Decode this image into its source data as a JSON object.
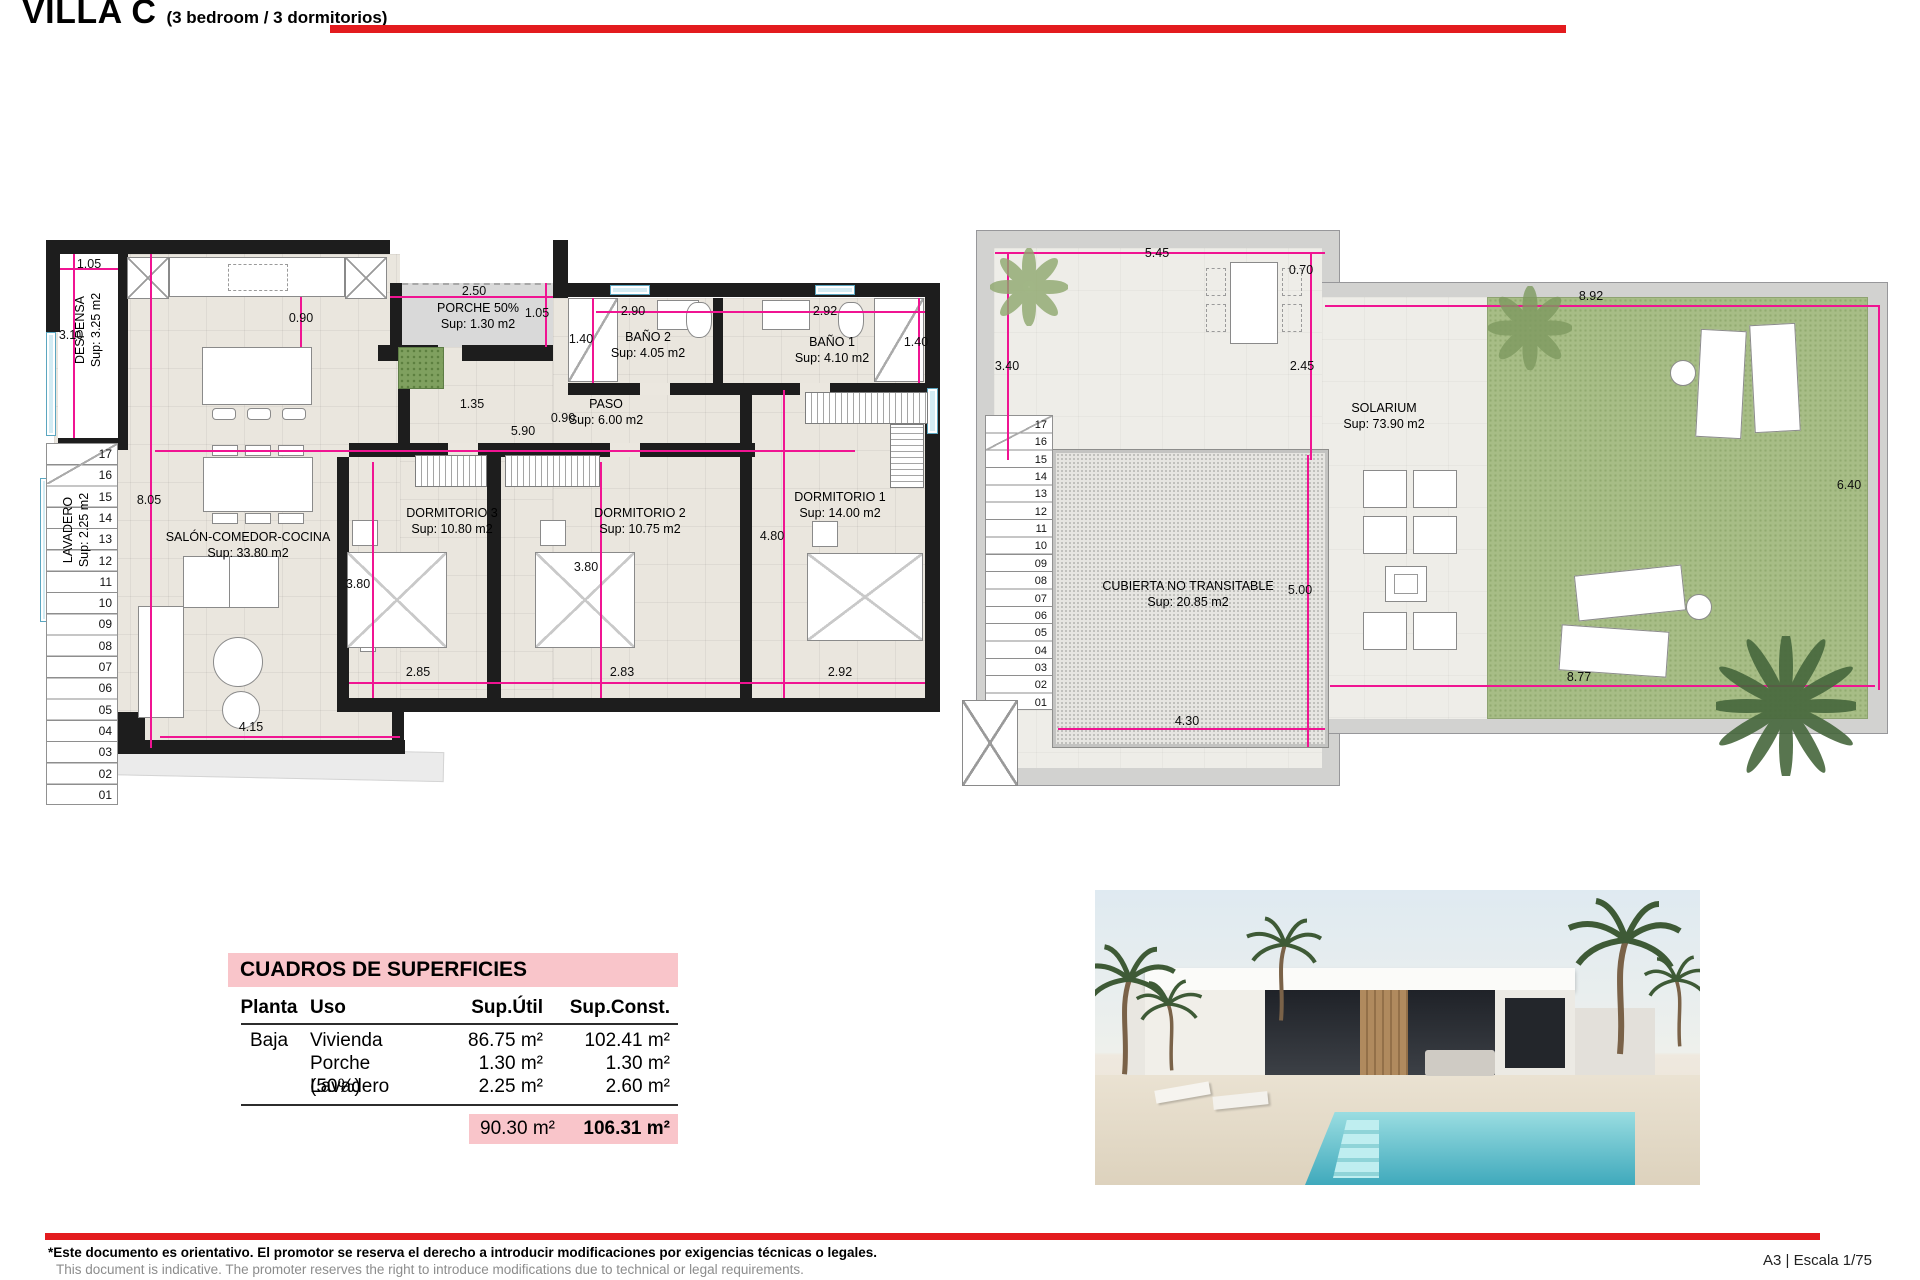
{
  "title": {
    "main": "VILLA C",
    "sub": "(3 bedroom / 3 dormitorios)"
  },
  "ground_plan": {
    "rooms": [
      {
        "name": "DESPENSA",
        "sup": "Sup: 3.25 m2",
        "x": 88,
        "y": 330,
        "vertical": true
      },
      {
        "name": "LAVADERO",
        "sup": "Sup: 2.25 m2",
        "x": 76,
        "y": 530,
        "vertical": true
      },
      {
        "name": "SALÓN-COMEDOR-COCINA",
        "sup": "Sup: 33.80 m2",
        "x": 248,
        "y": 545
      },
      {
        "name": "PORCHE 50%",
        "sup": "Sup: 1.30 m2",
        "x": 478,
        "y": 316
      },
      {
        "name": "BAÑO 2",
        "sup": "Sup: 4.05 m2",
        "x": 648,
        "y": 345
      },
      {
        "name": "BAÑO 1",
        "sup": "Sup: 4.10 m2",
        "x": 832,
        "y": 350
      },
      {
        "name": "PASO",
        "sup": "Sup: 6.00 m2",
        "x": 606,
        "y": 412
      },
      {
        "name": "DORMITORIO 3",
        "sup": "Sup: 10.80 m2",
        "x": 452,
        "y": 521
      },
      {
        "name": "DORMITORIO 2",
        "sup": "Sup: 10.75 m2",
        "x": 640,
        "y": 521
      },
      {
        "name": "DORMITORIO 1",
        "sup": "Sup: 14.00 m2",
        "x": 840,
        "y": 505
      }
    ],
    "dimensions": [
      {
        "t": "1.05",
        "x": 89,
        "y": 264
      },
      {
        "t": "3.10",
        "x": 71,
        "y": 335
      },
      {
        "t": "0.90",
        "x": 301,
        "y": 318
      },
      {
        "t": "2.50",
        "x": 474,
        "y": 291
      },
      {
        "t": "1.05",
        "x": 537,
        "y": 313
      },
      {
        "t": "1.40",
        "x": 581,
        "y": 339
      },
      {
        "t": "2.90",
        "x": 633,
        "y": 311
      },
      {
        "t": "2.92",
        "x": 825,
        "y": 311
      },
      {
        "t": "1.40",
        "x": 916,
        "y": 342
      },
      {
        "t": "1.35",
        "x": 472,
        "y": 404
      },
      {
        "t": "0.90",
        "x": 563,
        "y": 418
      },
      {
        "t": "5.90",
        "x": 523,
        "y": 431
      },
      {
        "t": "8.05",
        "x": 149,
        "y": 500
      },
      {
        "t": "3.80",
        "x": 358,
        "y": 584
      },
      {
        "t": "3.80",
        "x": 586,
        "y": 567
      },
      {
        "t": "4.80",
        "x": 772,
        "y": 536
      },
      {
        "t": "2.85",
        "x": 418,
        "y": 672
      },
      {
        "t": "2.83",
        "x": 622,
        "y": 672
      },
      {
        "t": "2.92",
        "x": 840,
        "y": 672
      },
      {
        "t": "4.15",
        "x": 251,
        "y": 727
      }
    ]
  },
  "roof_plan": {
    "rooms": [
      {
        "name": "SOLARIUM",
        "sup": "Sup: 73.90 m2",
        "x": 1384,
        "y": 416
      },
      {
        "name": "CUBIERTA NO TRANSITABLE",
        "sup": "Sup: 20.85 m2",
        "x": 1188,
        "y": 594
      }
    ],
    "dimensions": [
      {
        "t": "5.45",
        "x": 1157,
        "y": 253
      },
      {
        "t": "0.70",
        "x": 1301,
        "y": 270
      },
      {
        "t": "3.40",
        "x": 1007,
        "y": 366
      },
      {
        "t": "2.45",
        "x": 1302,
        "y": 366
      },
      {
        "t": "8.92",
        "x": 1591,
        "y": 296
      },
      {
        "t": "6.40",
        "x": 1849,
        "y": 485
      },
      {
        "t": "5.00",
        "x": 1300,
        "y": 590
      },
      {
        "t": "4.30",
        "x": 1187,
        "y": 721
      },
      {
        "t": "8.77",
        "x": 1579,
        "y": 677
      }
    ]
  },
  "stair_numbers": [
    "17",
    "16",
    "15",
    "14",
    "13",
    "12",
    "11",
    "10",
    "09",
    "08",
    "07",
    "06",
    "05",
    "04",
    "03",
    "02",
    "01"
  ],
  "areas_table": {
    "title": "CUADROS DE SUPERFICIES",
    "headers": [
      "Planta",
      "Uso",
      "Sup.Útil",
      "Sup.Const."
    ],
    "rows": [
      {
        "planta": "Baja",
        "uso": "Vivienda",
        "util": "86.75 m²",
        "const": "102.41 m²"
      },
      {
        "planta": "",
        "uso": "Porche (50%)",
        "util": "1.30 m²",
        "const": "1.30 m²"
      },
      {
        "planta": "",
        "uso": "Lavadero",
        "util": "2.25 m²",
        "const": "2.60 m²"
      }
    ],
    "totals": {
      "util": "90.30 m²",
      "const": "106.31 m²"
    }
  },
  "footer": {
    "disclaimer_es": "*Este documento es orientativo. El promotor se reserva el derecho a introducir modificaciones por exigencias técnicas o legales.",
    "disclaimer_en": "This document is indicative. The promoter reserves the right to introduce modifications due to technical or legal requirements.",
    "sheet_info": "A3 | Escala 1/75"
  },
  "colors": {
    "accent_red": "#e31b1e",
    "dim_pink": "#f01492",
    "table_pink": "#f9c5ca",
    "grass": "#a7bd86",
    "wall": "#1d1d1d"
  }
}
